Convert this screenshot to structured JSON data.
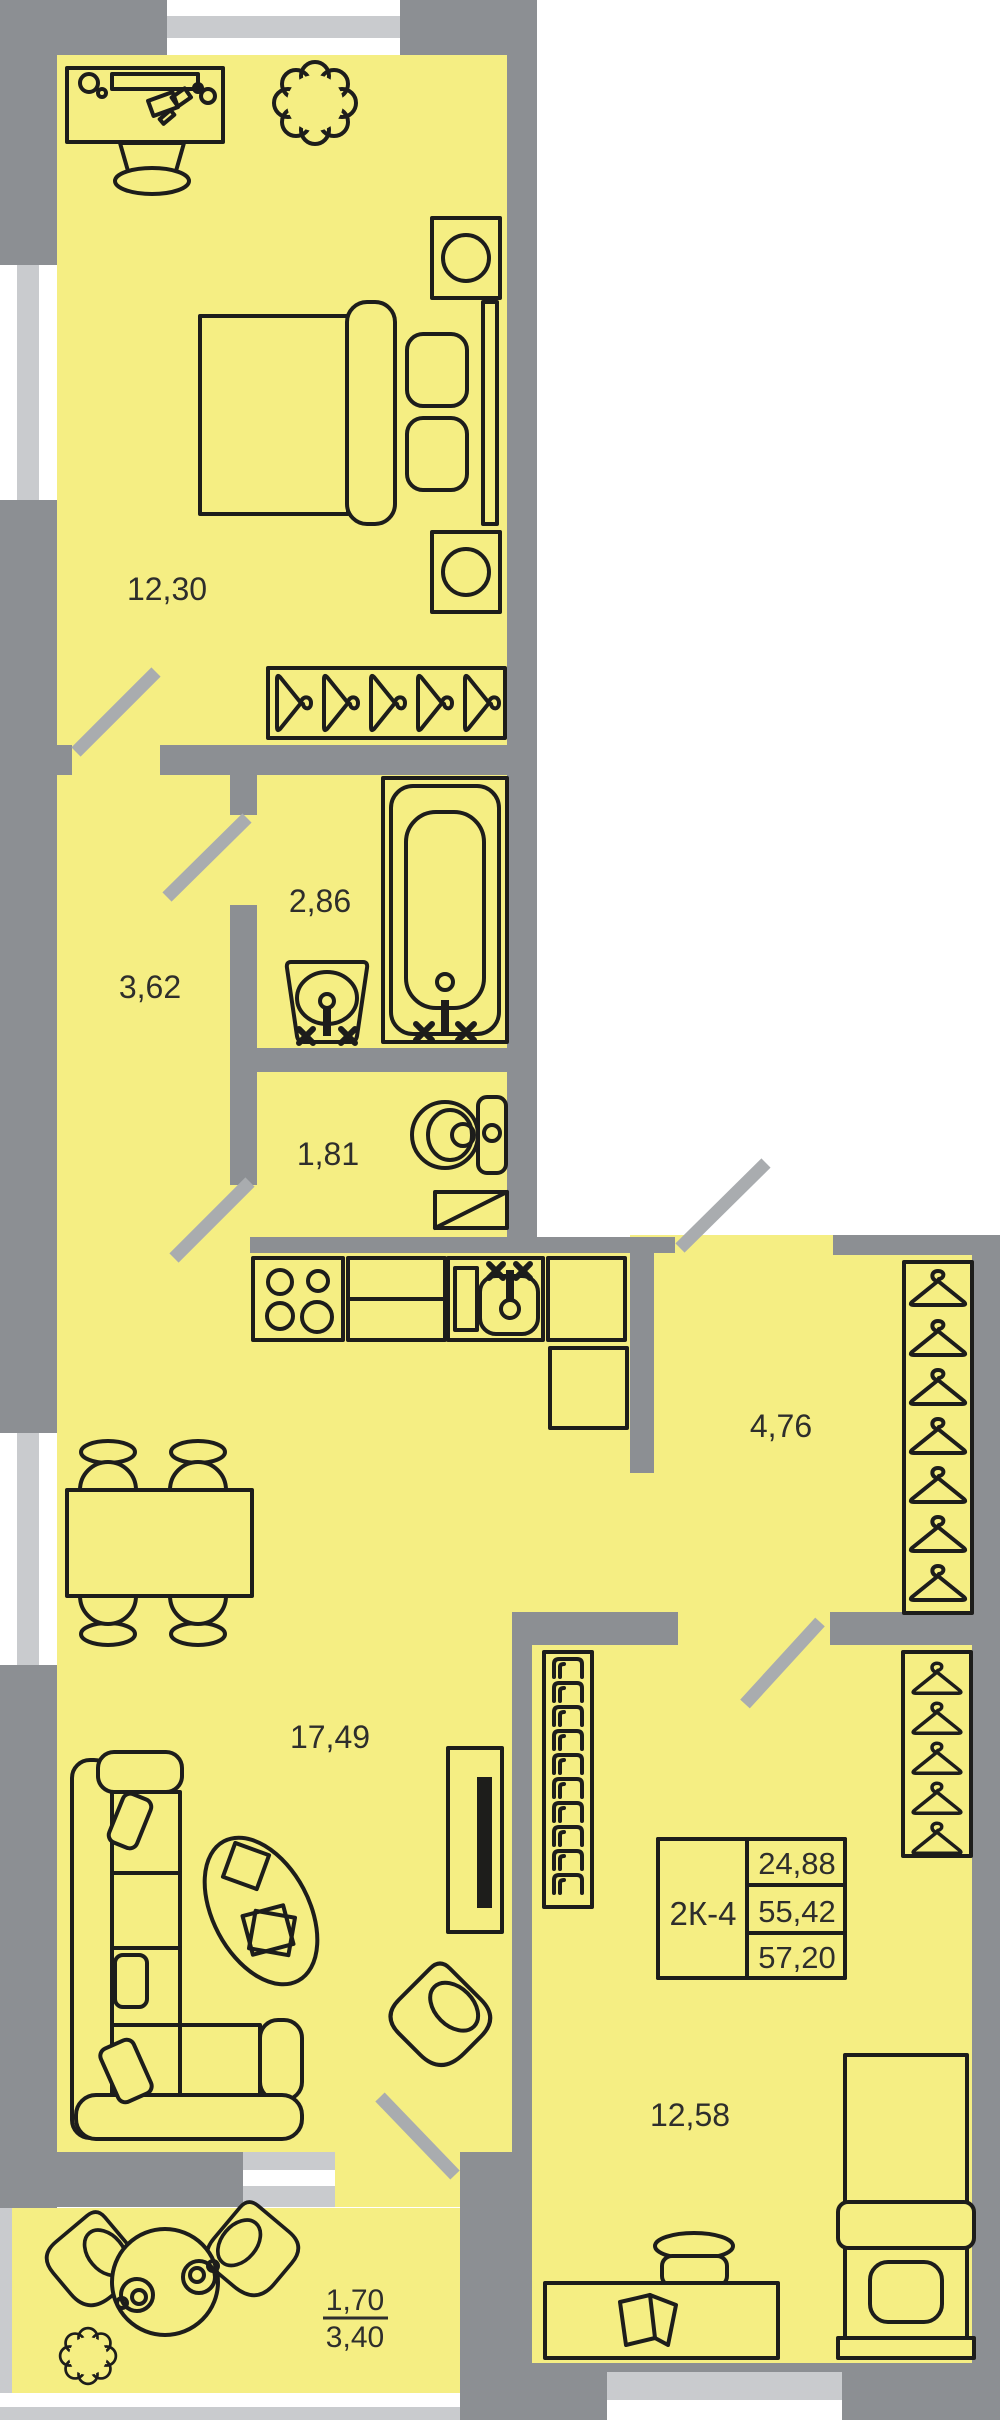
{
  "unit": {
    "code": "2К-4",
    "values": [
      "24,88",
      "55,42",
      "57,20"
    ]
  },
  "rooms": {
    "bedroom_top": "12,30",
    "hall": "3,62",
    "bathroom": "2,86",
    "wc": "1,81",
    "corridor": "4,76",
    "living_kitchen": "17,49",
    "bedroom_bottom": "12,58"
  },
  "balcony": {
    "reduced_area": "1,70",
    "full_area": "3,40"
  },
  "colors": {
    "floor": "#F5EE83",
    "wall": "#8C8F93",
    "window_glass": "#C9CBCE",
    "door_leaf": "#A9ACAF",
    "outline": "#1D1D1B",
    "label_text": "#2E2E2C",
    "background": "#FFFFFF"
  },
  "icons": [
    "desk-icon",
    "office-chair-icon",
    "plant-icon",
    "nightstand-icon",
    "double-bed-icon",
    "hanger-icon",
    "bathtub-icon",
    "washbasin-icon",
    "toilet-icon",
    "washer-icon",
    "stove-icon",
    "kitchen-counter-icon",
    "kitchen-sink-icon",
    "cabinet-icon",
    "fridge-icon",
    "dining-table-icon",
    "dining-chair-icon",
    "sofa-icon",
    "coffee-table-icon",
    "tv-icon",
    "armchair-icon",
    "bookshelf-icon",
    "single-bed-icon",
    "balcony-table-icon",
    "cup-icon",
    "door-leaf-icon",
    "window-icon"
  ]
}
